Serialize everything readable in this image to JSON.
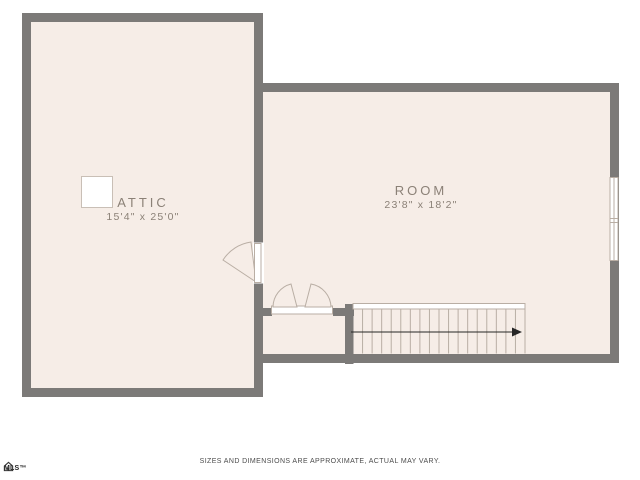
{
  "plan": {
    "rooms": [
      {
        "id": "attic",
        "label": "ATTIC",
        "dimensions": "15'4\" x 25'0\""
      },
      {
        "id": "room",
        "label": "ROOM",
        "dimensions": "23'8\" x 18'2\""
      }
    ],
    "stairs": {
      "treads": 18,
      "direction": "right"
    },
    "disclaimer": "SIZES AND DIMENSIONS ARE APPROXIMATE, ACTUAL MAY VARY.",
    "logo": {
      "text": "MLS™"
    },
    "colors": {
      "floor": "#f6ede7",
      "wall": "#7c7a78",
      "outline": "#b9aea4",
      "label": "#8b8177",
      "disclaimer": "#4c4c4c",
      "arrow": "#262626"
    }
  }
}
